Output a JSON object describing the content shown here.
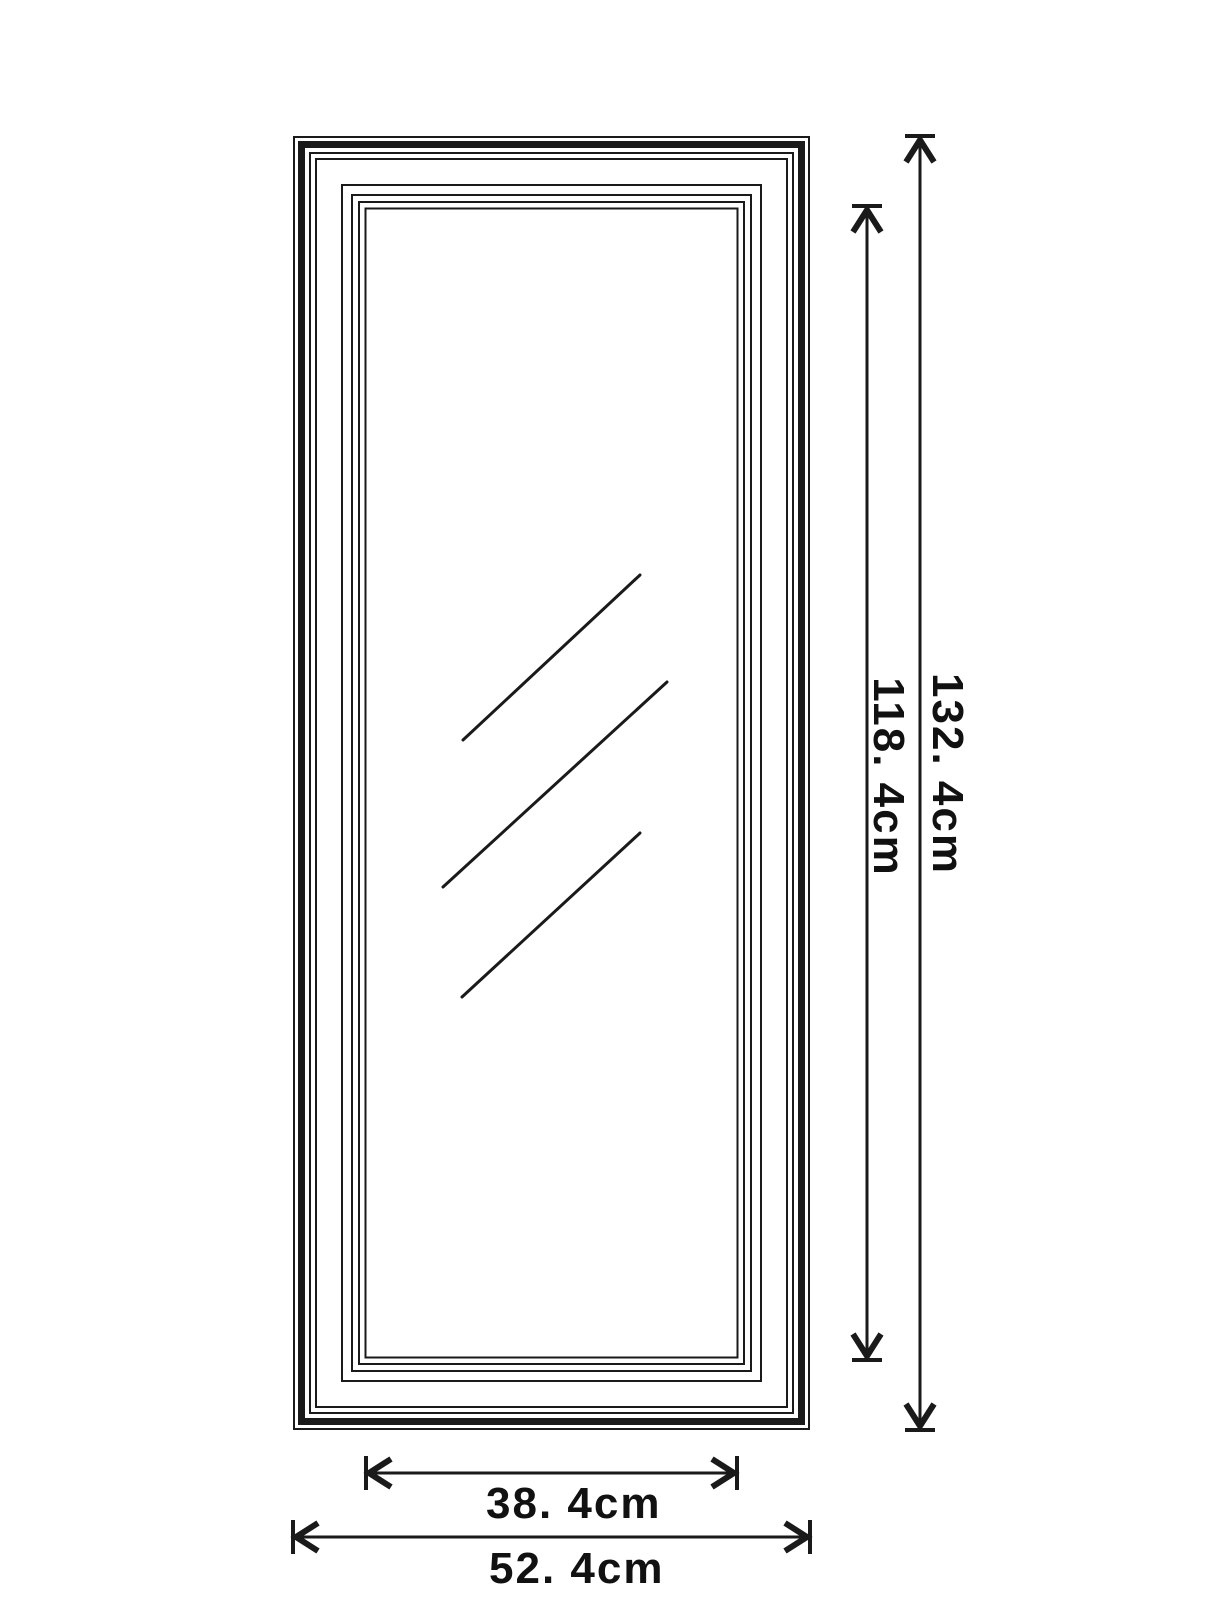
{
  "title": "Mirror frame dimension drawing",
  "dimensions": {
    "outer_height_label": "132. 4cm",
    "inner_height_label": "118. 4cm",
    "inner_width_label": "38. 4cm",
    "outer_width_label": "52. 4cm"
  },
  "drawing": {
    "subject": "framed rectangular mirror, front elevation",
    "outer_width_cm": 52.4,
    "outer_height_cm": 132.4,
    "inner_width_cm": 38.4,
    "inner_height_cm": 118.4,
    "molding_line_count": 8,
    "reflection_line_count": 3
  },
  "colors": {
    "line": "#1a1a1a",
    "background": "#ffffff",
    "text": "#111111"
  }
}
